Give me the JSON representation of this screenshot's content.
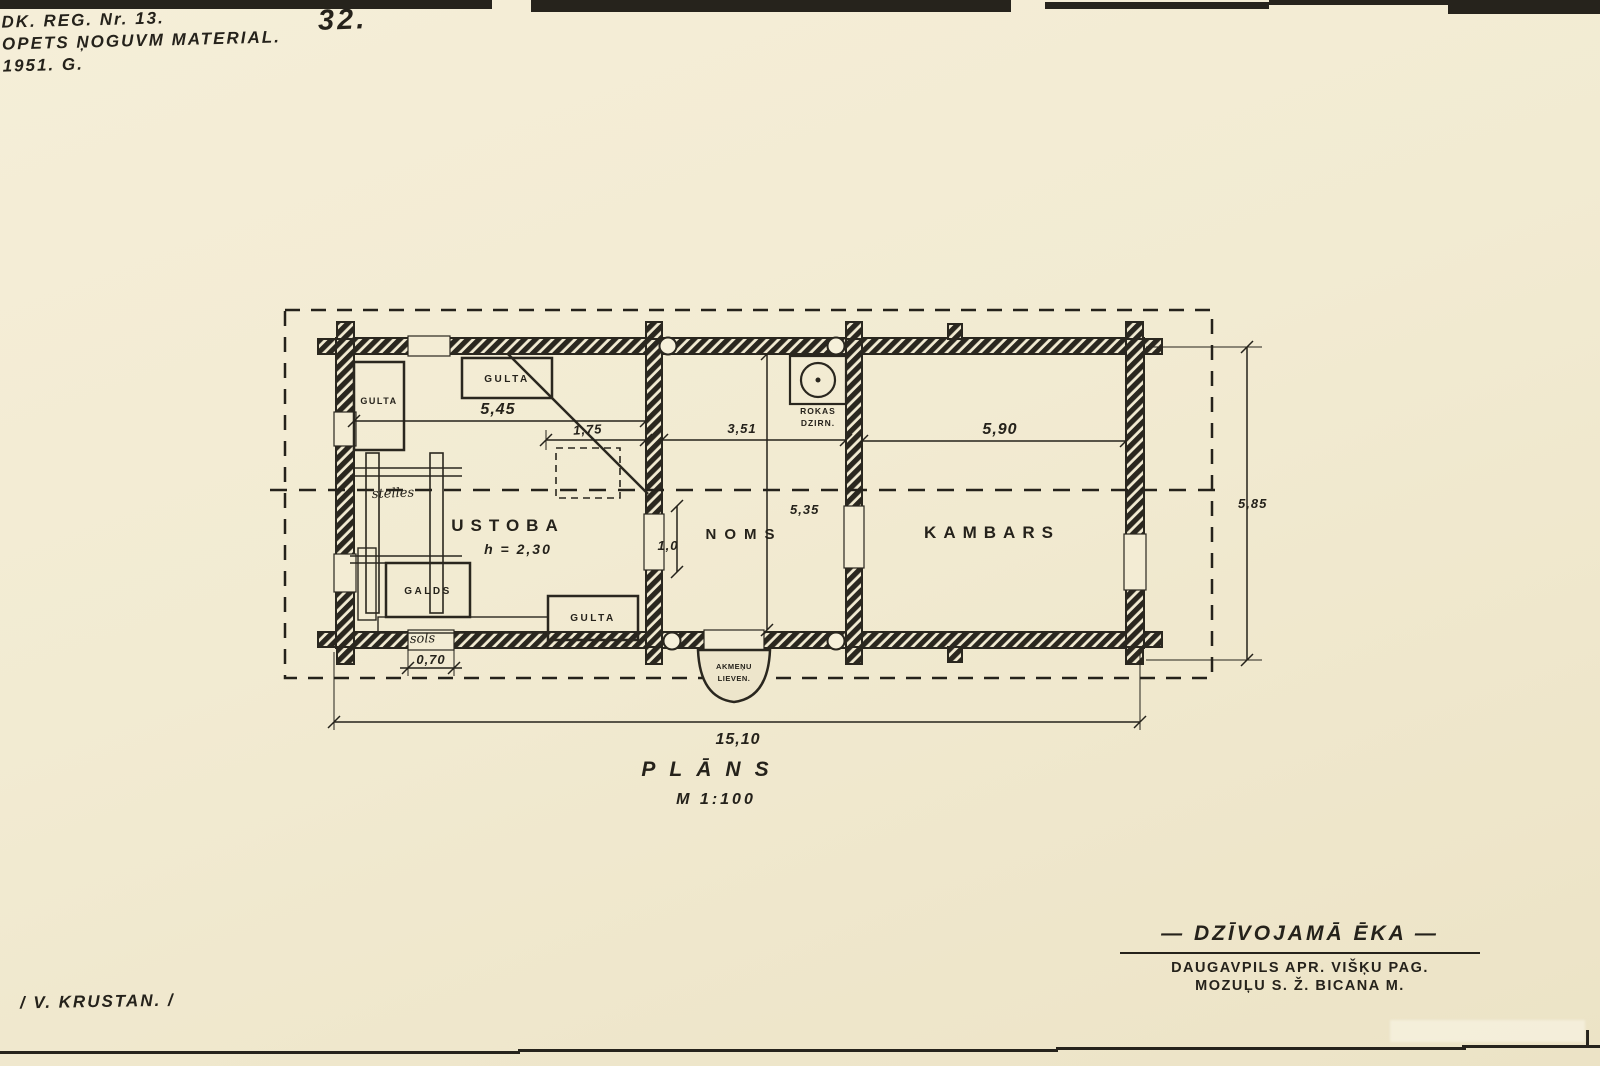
{
  "colors": {
    "paper": "#f2ebd2",
    "ink": "#25221b"
  },
  "header": {
    "reg_line": "DK. REG. Nr. 13.",
    "material_line": "OPETS ŅOGUVM MATERIAL.",
    "year_line": "1951. G.",
    "page_number": "32."
  },
  "plan": {
    "room_ustoba": "USTOBA",
    "room_ustoba_height": "h = 2,30",
    "room_noms": "NOMS",
    "room_kambars": "KAMBARS",
    "bed_top": "GULTA",
    "bed_left": "GULTA",
    "bed_bottom": "GULTA",
    "table": "GALDS",
    "bench": "sols",
    "loom": "stelles",
    "mill_line1": "ROKAS",
    "mill_line2": "DZIRN.",
    "porch_line1": "AKMEŅU",
    "porch_line2": "LIEVEN.",
    "dim_ustoba": "5,45",
    "dim_oven": "1,75",
    "dim_noms": "3,51",
    "dim_kambars": "5,90",
    "dim_depth_inner": "5,35",
    "dim_door": "1,0",
    "dim_window": "0,70",
    "dim_total_width": "15,10",
    "dim_total_depth": "5,85",
    "caption_title": "PLĀNS",
    "caption_scale": "M 1:100"
  },
  "footer": {
    "signature": "/ V. KRUSTAN. /",
    "title": "— DZĪVOJAMĀ  ĒKA —",
    "address_line1": "DAUGAVPILS APR. VIŠĶU PAG.",
    "address_line2": "MOZUĻU S.  Ž. BICANA M."
  }
}
